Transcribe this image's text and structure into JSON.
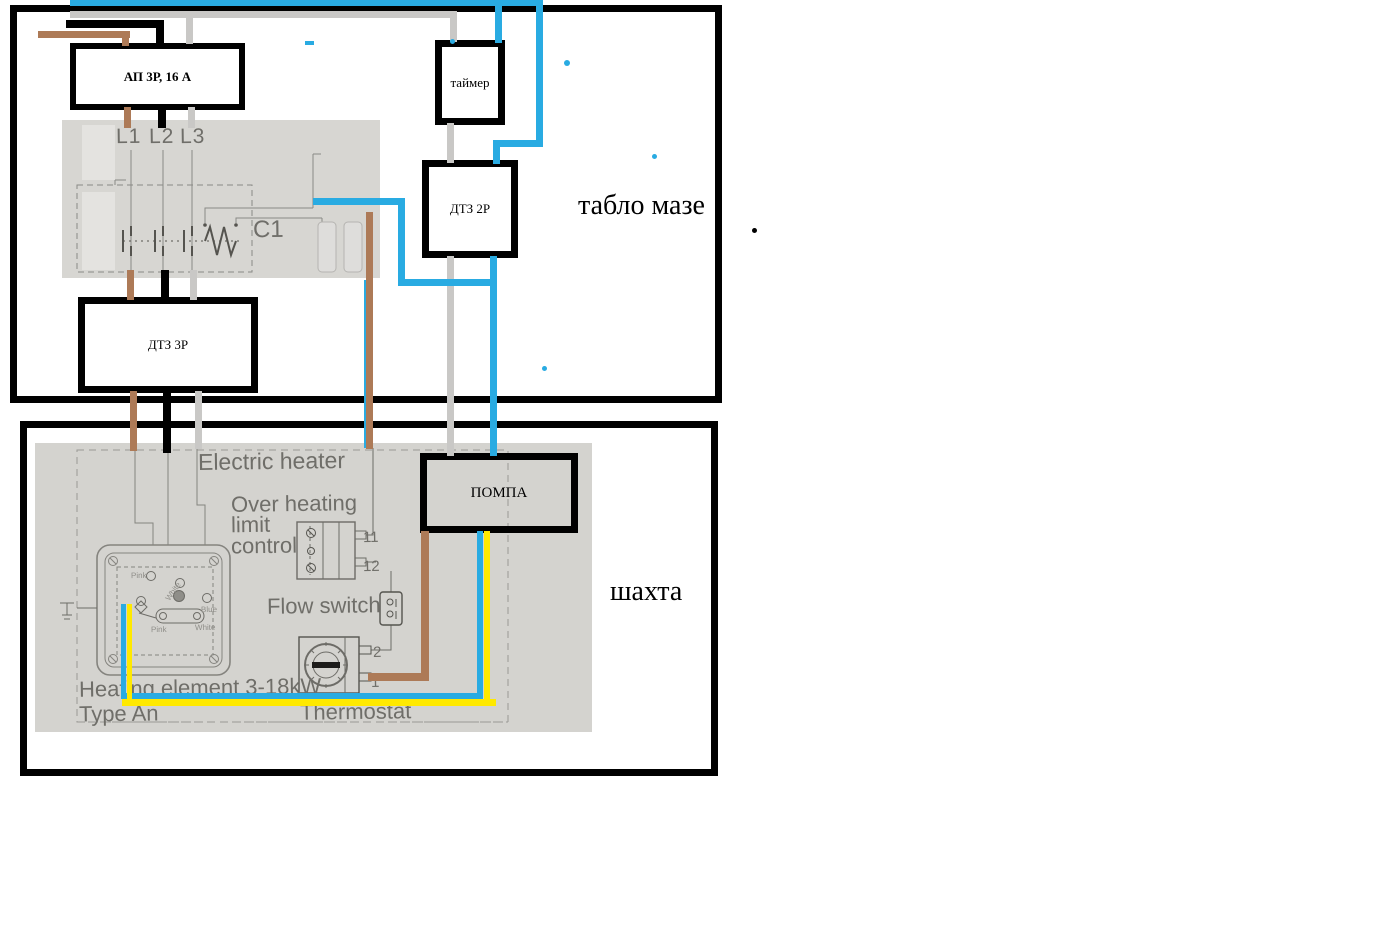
{
  "zones": {
    "tablo": {
      "label": "табло мазе"
    },
    "shahta": {
      "label": "шахта"
    }
  },
  "components": {
    "breaker": {
      "label": "АП 3Р, 16 А"
    },
    "timer": {
      "label": "таймер"
    },
    "dtz2p": {
      "label": "ДТЗ 2Р"
    },
    "dtz3p": {
      "label": "ДТЗ 3Р"
    },
    "pump": {
      "label": "ПОМПА"
    }
  },
  "contactor_scan": {
    "l1": "L1",
    "l2": "L2",
    "l3": "L3",
    "c1": "C1"
  },
  "heater_scan": {
    "title": "Electric heater",
    "overheat_line1": "Over heating",
    "overheat_line2": "limit",
    "overheat_line3": "control",
    "flow_switch": "Flow switch",
    "heating_element": "Heating element 3-18kW",
    "type_label": "Type An",
    "thermostat": "Thermostat",
    "terminal_11": "11",
    "terminal_12": "12",
    "terminal_2": "2",
    "terminal_1": "1",
    "plate_labels": {
      "pink_top": "Pink",
      "white_top": "White",
      "blue_right": "Blue",
      "pink_bottom": "Pink",
      "white_bottom": "White"
    }
  },
  "wire_colors": {
    "phase_l1_brown": "#ad7a57",
    "phase_l2_black": "#000000",
    "phase_l3_gray": "#c9c8c6",
    "control_blue": "#29abe2",
    "signal_yellow": "#ffe900"
  }
}
